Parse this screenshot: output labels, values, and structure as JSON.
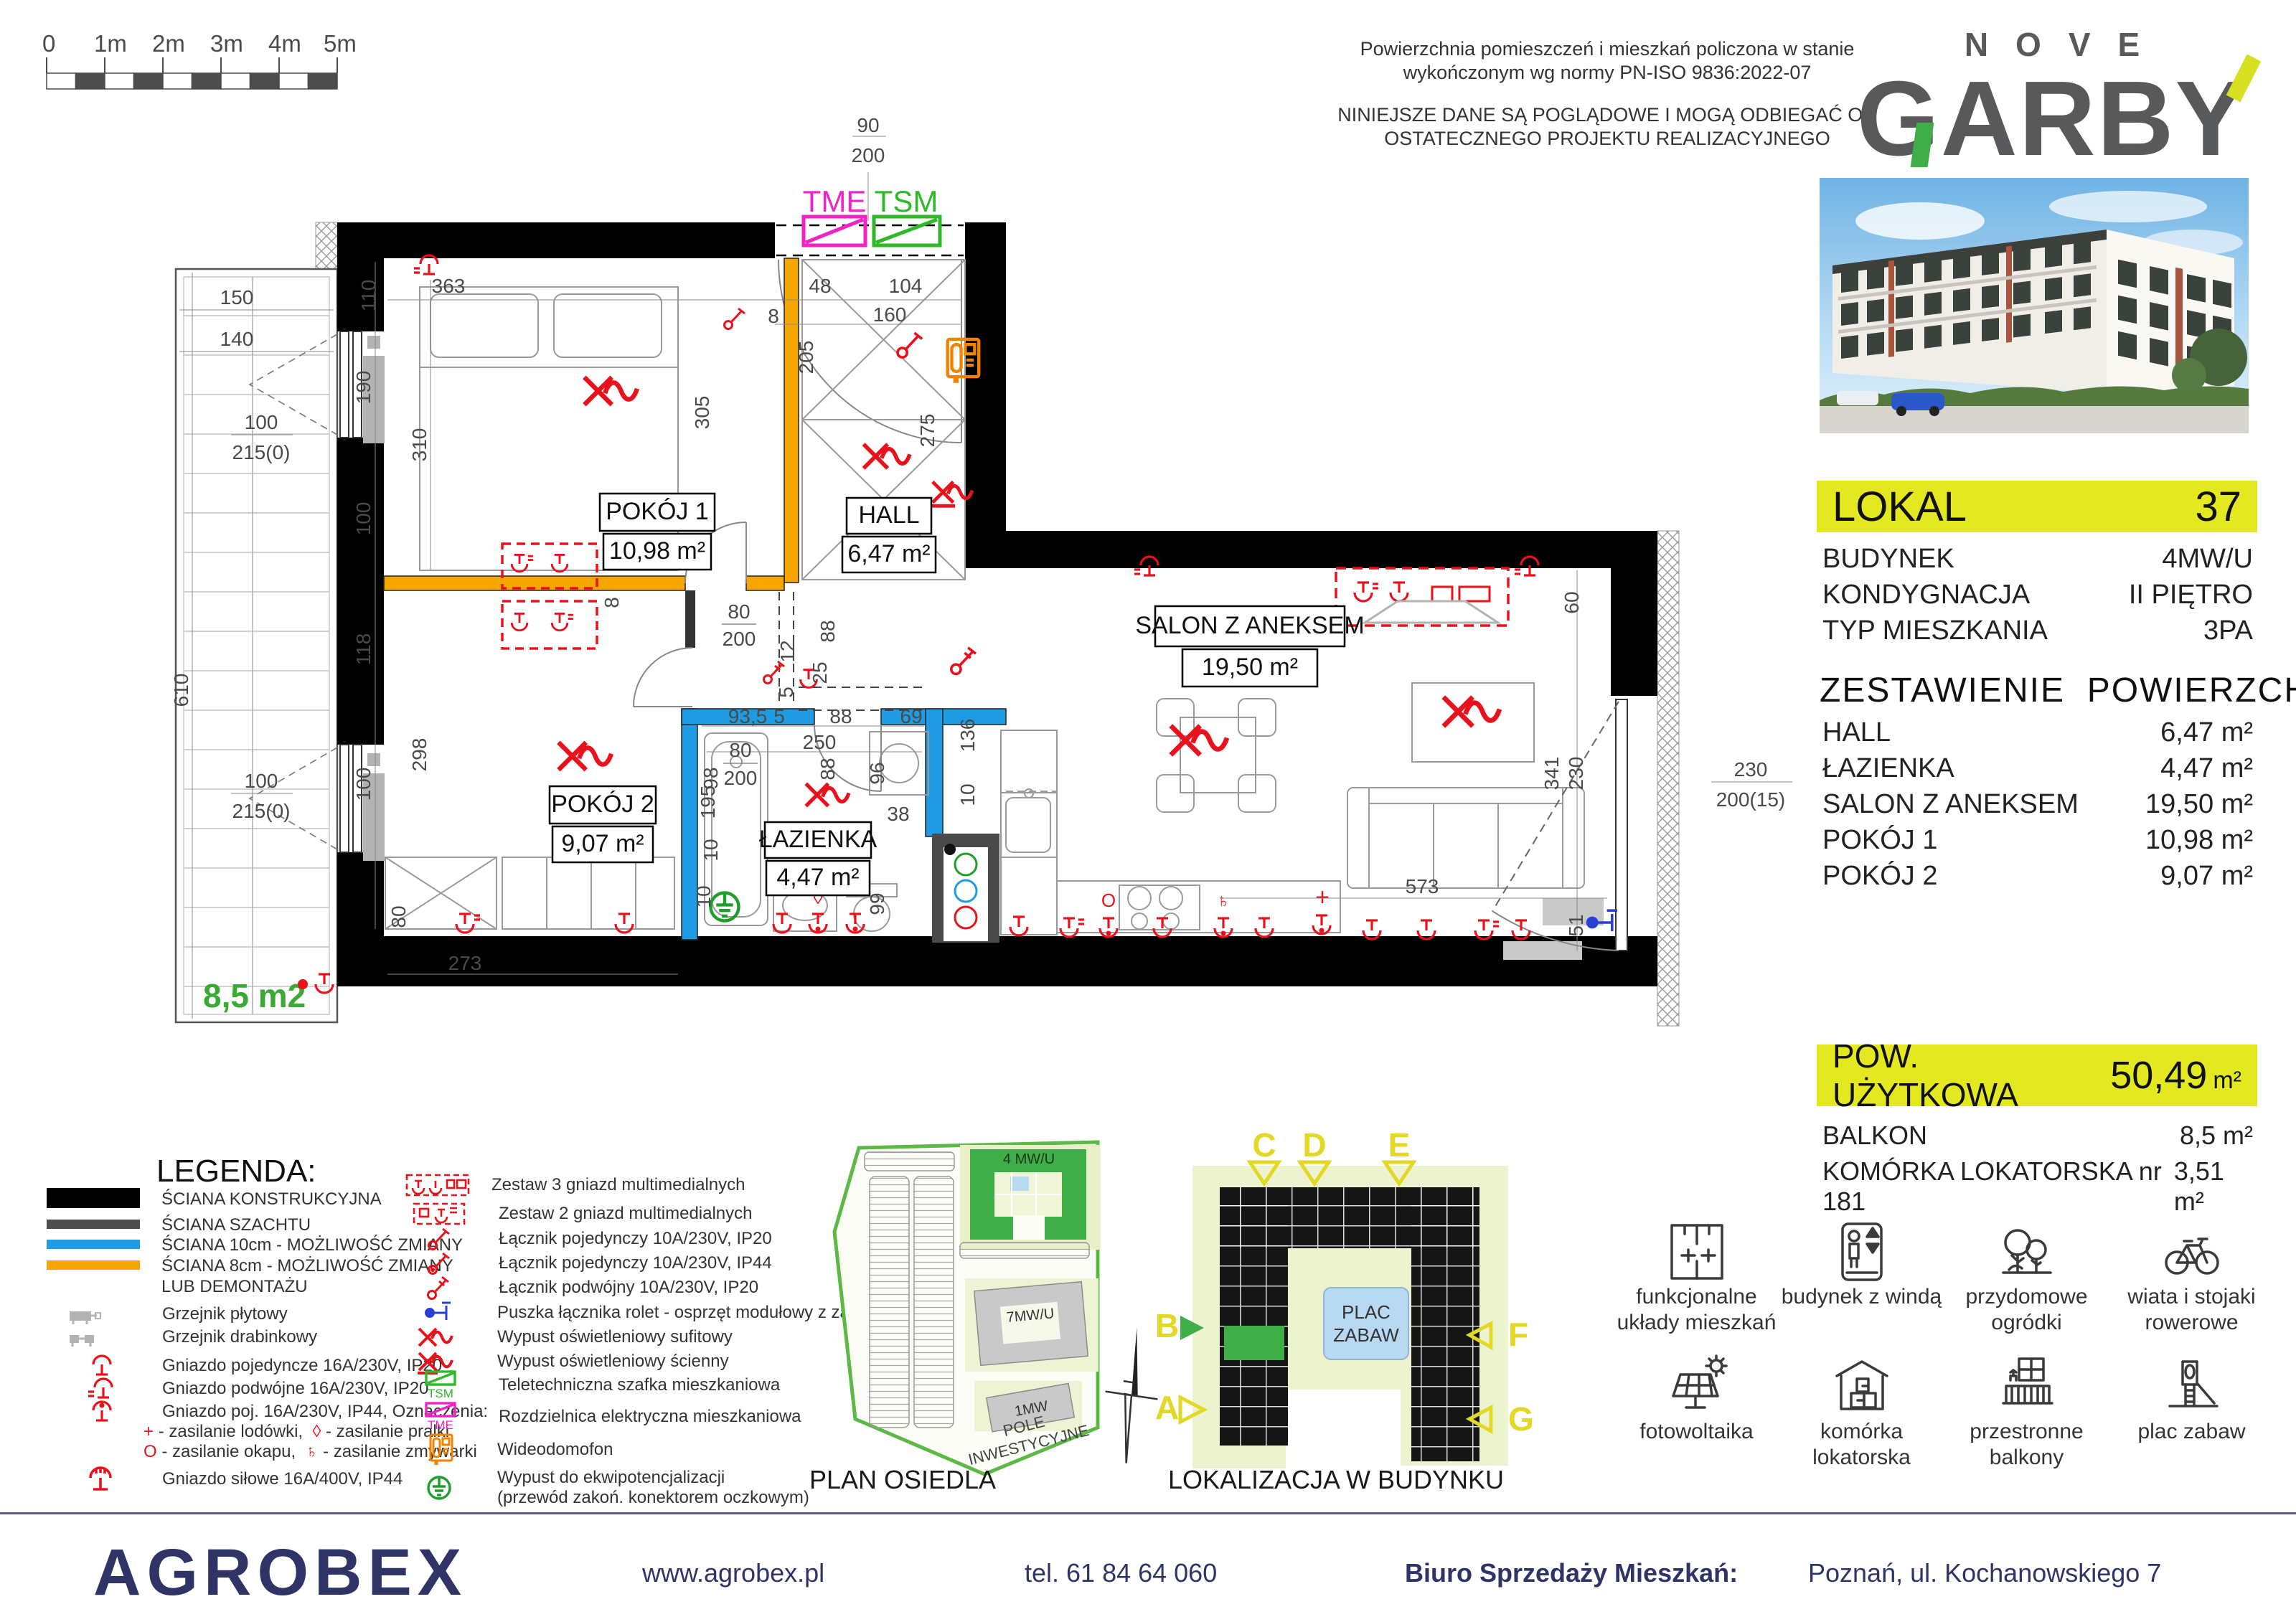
{
  "scale_bar": {
    "labels": [
      "0",
      "1m",
      "2m",
      "3m",
      "4m",
      "5m"
    ]
  },
  "disclaimer": {
    "line1": "Powierzchnia pomieszczeń i mieszkań policzona w stanie",
    "line2": "wykończonym wg normy PN-ISO 9836:2022-07",
    "line3": "NINIEJSZE DANE SĄ POGLĄDOWE I MOGĄ ODBIEGAĆ OD",
    "line4": "OSTATECZNEGO PROJEKTU REALIZACYJNEGO"
  },
  "brand": {
    "top": "NOVE",
    "g": "G",
    "a": "A",
    "r": "R",
    "b": "B",
    "y": "Y"
  },
  "unit_info": {
    "label": "LOKAL",
    "number": "37",
    "rows": [
      {
        "label": "BUDYNEK",
        "value": "4MW/U"
      },
      {
        "label": "KONDYGNACJA",
        "value": "II PIĘTRO"
      },
      {
        "label": "TYP MIESZKANIA",
        "value": "3PA"
      }
    ]
  },
  "areas": {
    "heading": "ZESTAWIENIE  POWIERZCHNI",
    "rows": [
      {
        "label": "HALL",
        "value": "6,47 m²"
      },
      {
        "label": "ŁAZIENKA",
        "value": "4,47 m²"
      },
      {
        "label": "SALON Z ANEKSEM",
        "value": "19,50 m²"
      },
      {
        "label": "POKÓJ 1",
        "value": "10,98 m²"
      },
      {
        "label": "POKÓJ 2",
        "value": "9,07 m²"
      }
    ]
  },
  "usable_area": {
    "label": "POW. UŻYTKOWA",
    "value": "50,49",
    "unit": "m²"
  },
  "extras": [
    {
      "label": "BALKON",
      "value": "8,5 m²"
    },
    {
      "label": "KOMÓRKA LOKATORSKA nr 181",
      "value": "3,51 m²"
    }
  ],
  "features": [
    "funkcjonalne układy mieszkań",
    "budynek z windą",
    "przydomowe ogródki",
    "wiata i stojaki rowerowe",
    "fotowoltaika",
    "komórka lokatorska",
    "przestronne balkony",
    "plac zabaw"
  ],
  "legend": {
    "title": "LEGENDA:",
    "walls": [
      "ŚCIANA KONSTRUKCYJNA",
      "ŚCIANA SZACHTU",
      "ŚCIANA 10cm - MOŻLIWOŚĆ ZMIANY",
      "ŚCIANA 8cm - MOŻLIWOŚĆ ZMIANY",
      "LUB DEMONTAŻU"
    ],
    "items_left": [
      "Grzejnik płytowy",
      "Grzejnik drabinkowy",
      "Gniazdo pojedyncze 16A/230V, IP20",
      "Gniazdo podwójne 16A/230V, IP20",
      "Gniazdo poj. 16A/230V, IP44, Oznaczenia:",
      "Gniazdo siłowe 16A/400V, IP44"
    ],
    "ozn1_sym": "+",
    "ozn1_txt": "- zasilanie lodówki,",
    "ozn2_sym": "◊",
    "ozn2_txt": "- zasilanie pralki",
    "ozn3_sym": "O",
    "ozn3_txt": "- zasilanie okapu,",
    "ozn4_sym": "♄",
    "ozn4_txt": "- zasilanie zmywarki",
    "items_right": [
      "Zestaw 3 gniazd multimedialnych",
      "Zestaw 2 gniazd multimedialnych",
      "Łącznik pojedynczy 10A/230V, IP20",
      "Łącznik pojedynczy 10A/230V, IP44",
      "Łącznik podwójny 10A/230V, IP20",
      "Puszka łącznika rolet - osprzęt modułowy z zaślepką",
      "Wypust oświetleniowy sufitowy",
      "Wypust oświetleniowy ścienny",
      "Teletechniczna szafka mieszkaniowa",
      "Rozdzielnica elektryczna mieszkaniowa",
      "Wideodomofon",
      "Wypust do ekwipotencjalizacji",
      "(przewód zakoń. konektorem oczkowym)"
    ],
    "tsm": "TSM",
    "tme": "TME"
  },
  "site_plan": {
    "caption": "PLAN OSIEDLA",
    "building_a": "4 MW/U",
    "building_b": "7MW/U",
    "building_c": "1MW",
    "field_1": "POLE",
    "field_2": "INWESTYCYJNE"
  },
  "locator": {
    "caption": "LOKALIZACJA  W BUDYNKU",
    "playground_1": "PLAC",
    "playground_2": "ZABAW",
    "markers": {
      "c": "C",
      "d": "D",
      "e": "E",
      "f": "F",
      "g": "G",
      "b": "B",
      "a": "A"
    }
  },
  "plan": {
    "rooms": {
      "pokoj1": {
        "name": "POKÓJ 1",
        "area": "10,98 m²"
      },
      "hall": {
        "name": "HALL",
        "area": "6,47 m²"
      },
      "salon": {
        "name": "SALON Z ANEKSEM",
        "area": "19,50 m²"
      },
      "pokoj2": {
        "name": "POKÓJ 2",
        "area": "9,07 m²"
      },
      "lazienka": {
        "name": "ŁAZIENKA",
        "area": "4,47 m²"
      }
    },
    "balcony_area": "8,5 m2",
    "tme": "TME",
    "tsm": "TSM",
    "dims": [
      "363",
      "110",
      "190",
      "310",
      "100",
      "118",
      "298",
      "100",
      "80",
      "273",
      "8",
      "48",
      "104",
      "160",
      "205",
      "305",
      "80",
      "200",
      "88",
      "12",
      "25",
      "5",
      "80",
      "200",
      "98",
      "88",
      "10",
      "136",
      "10",
      "93,5",
      "5",
      "88",
      "69",
      "250",
      "96",
      "38",
      "195",
      "10",
      "99",
      "60",
      "341",
      "230",
      "573",
      "51",
      "90",
      "200",
      "150",
      "140",
      "610",
      "100",
      "215(0)",
      "100",
      "215(0)",
      "230",
      "200(15)",
      "275",
      "8"
    ]
  },
  "footer": {
    "company": "AGROBEX",
    "website": "www.agrobex.pl",
    "phone": "tel. 61 84 64 060",
    "office_label": "Biuro Sprzedaży Mieszkań:",
    "address": "Poznań, ul. Kochanowskiego 7"
  }
}
